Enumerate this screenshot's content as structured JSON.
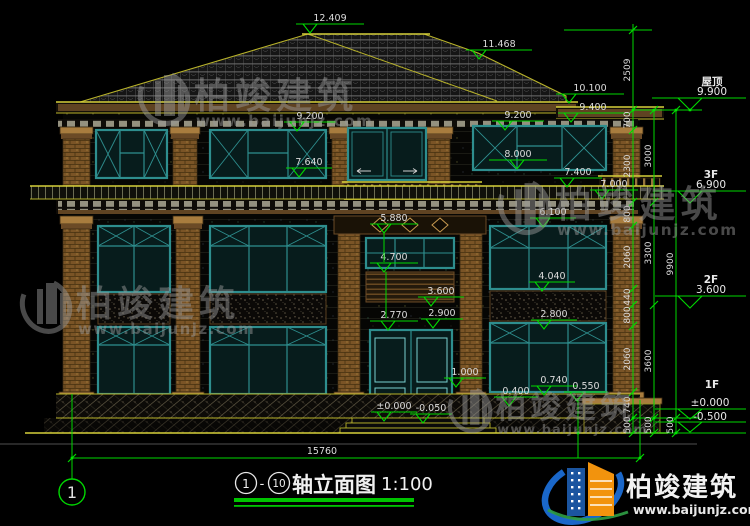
{
  "drawing": {
    "title": "轴立面图",
    "scale": "1:100",
    "axis_start": "1",
    "separator": "-",
    "axis_end": "10",
    "total_width": "15760",
    "axis_bubble": "1"
  },
  "levels": {
    "roof_label": "屋顶",
    "roof_value": "9.900",
    "f3_label": "3F",
    "f3_value": "6.900",
    "f2_label": "2F",
    "f2_value": "3.600",
    "f1_label": "1F",
    "f1_value": "±0.000",
    "below_ground_value": "-0.500"
  },
  "markers": [
    "12.409",
    "11.468",
    "10.100",
    "9.400",
    "9.200",
    "9.200",
    "8.000",
    "7.640",
    "7.400",
    "7.000",
    "6.100",
    "5.880",
    "4.700",
    "4.040",
    "3.600",
    "2.900",
    "2.770",
    "2.800",
    "1.000",
    "0.740",
    "0.400",
    "0.550",
    "±0.000",
    "-0.050"
  ],
  "dims_inner": [
    "2509",
    "700",
    "2300",
    "800",
    "2060",
    "440",
    "800",
    "2060",
    "740",
    "500"
  ],
  "dims_mid": [
    "3000",
    "3300",
    "3600",
    "500"
  ],
  "dims_outer": [
    "9900",
    "500"
  ],
  "watermark": {
    "brand": "柏竣建筑",
    "url": "www.baijunjz.com"
  },
  "logo": {
    "brand": "柏竣建筑",
    "url": "www.baijunjz.com"
  },
  "colors": {
    "dimension_green": "#00d800",
    "cad_yellow": "#b9b32a",
    "window_teal": "#2e8e8e",
    "brand_blue": "#1a67c9",
    "brand_orange": "#f2930d"
  }
}
